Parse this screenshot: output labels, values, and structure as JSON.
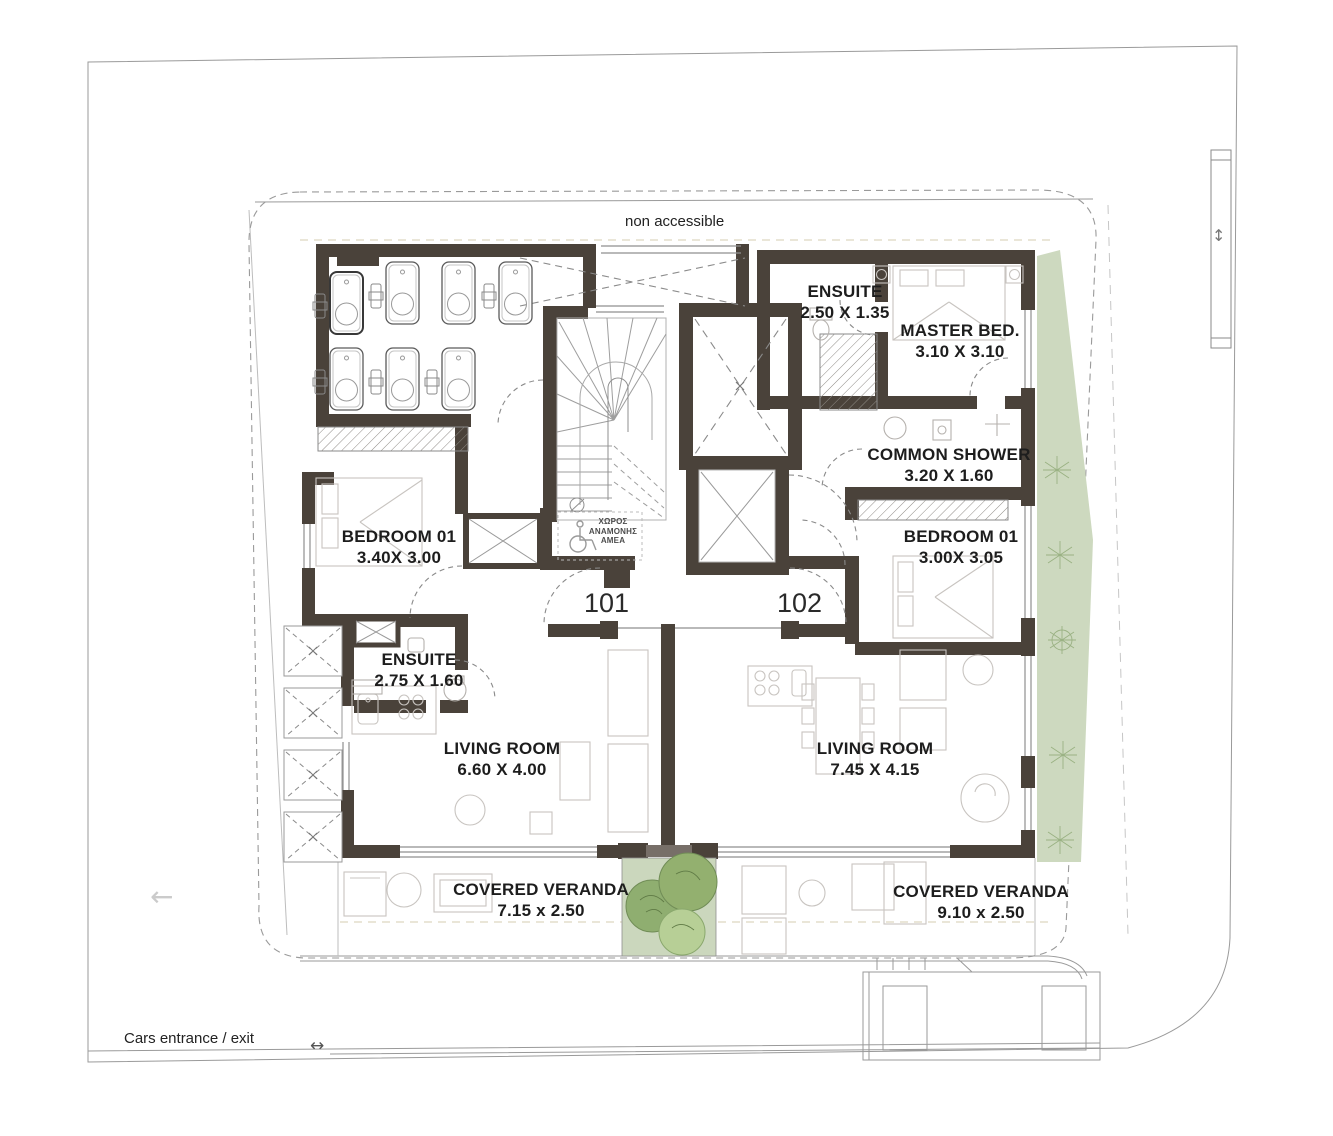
{
  "labels": {
    "non_accessible": "non accessible",
    "cars_entrance": "Cars entrance / exit",
    "waiting_area": [
      "ΧΩΡΟΣ",
      "ΑΝΑΜΟΝΗΣ",
      "ΑΜΕΑ"
    ]
  },
  "units": {
    "left_number": "101",
    "right_number": "102"
  },
  "rooms": {
    "ensuite_top": {
      "name": "ENSUITE",
      "dims": "2.50 X 1.35"
    },
    "master_bed": {
      "name": "MASTER BED.",
      "dims": "3.10 X 3.10"
    },
    "common_shower": {
      "name": "COMMON SHOWER",
      "dims": "3.20 X 1.60"
    },
    "bedroom_right": {
      "name": "BEDROOM 01",
      "dims": "3.00X 3.05"
    },
    "bedroom_left": {
      "name": "BEDROOM 01",
      "dims": "3.40X 3.00"
    },
    "ensuite_left": {
      "name": "ENSUITE",
      "dims": "2.75 X 1.60"
    },
    "living_left": {
      "name": "LIVING ROOM",
      "dims": "6.60 X 4.00"
    },
    "living_right": {
      "name": "LIVING ROOM",
      "dims": "7.45 X 4.15"
    },
    "veranda_left": {
      "name": "COVERED VERANDA",
      "dims": "7.15 x 2.50"
    },
    "veranda_right": {
      "name": "COVERED VERANDA",
      "dims": "9.10 x 2.50"
    }
  },
  "icons": {
    "arrow_left": "←",
    "arrow_both_h": "↔",
    "arrow_both_v": "↕"
  },
  "colors": {
    "wall": "#4a423a",
    "line": "#9a9a9a",
    "furniture_line": "#c8c4c0",
    "green_area": "#cdd9bf",
    "tree_dark": "#8fae70",
    "tree_light": "#b7cf96",
    "text": "#1e1e1e"
  }
}
